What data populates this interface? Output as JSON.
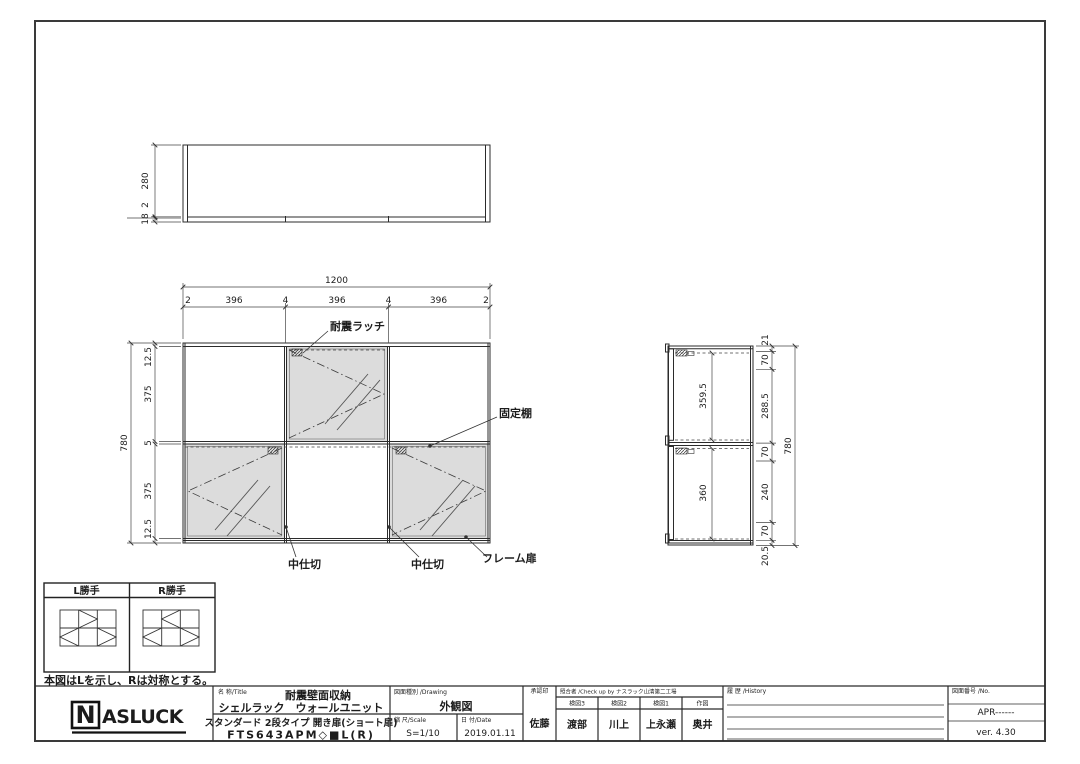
{
  "drawing": {
    "top_view": {
      "depth": "280",
      "gap": "2",
      "bottom": "18"
    },
    "front_view": {
      "width_total": "1200",
      "width_segments": [
        "2",
        "396",
        "4",
        "396",
        "4",
        "396",
        "2"
      ],
      "height_total": "780",
      "height_segments": [
        "12.5",
        "375",
        "5",
        "375",
        "12.5"
      ],
      "labels": {
        "latch": "耐震ラッチ",
        "fixed_shelf": "固定棚",
        "partition_left": "中仕切",
        "partition_right": "中仕切",
        "frame_door": "フレーム扉"
      }
    },
    "side_view": {
      "inner_top": "359.5",
      "inner_bottom": "360",
      "right_segments": [
        "21",
        "70",
        "288.5",
        "70",
        "240",
        "70",
        "20.5"
      ],
      "height_total": "780"
    },
    "handing": {
      "left": "L勝手",
      "right": "R勝手",
      "note": "本図はLを示し、Rは対称とする。"
    }
  },
  "title_block": {
    "logo": {
      "n": "N",
      "rest": "ASLUCK"
    },
    "name": {
      "header": "名 称/Title",
      "line1": "耐震壁面収納",
      "line2": "シェルラック　ウォールユニット",
      "line3": "スタンダード 2段タイプ 開き扉(ショート扉)",
      "line4": "FTS643APM◇■L(R)"
    },
    "drawing_type": {
      "header": "図面種別 /Drawing",
      "value": "外観図"
    },
    "scale": {
      "header": "縮 尺/Scale",
      "value": "S=1/10"
    },
    "date": {
      "header": "日 付/Date",
      "value": "2019.01.11"
    },
    "approval": {
      "header": "承認印",
      "value": "佐藤"
    },
    "check": {
      "header": "照合者 /Check up by ナスラック山清第二工場",
      "cols": [
        {
          "h": "検図3",
          "v": "渡部"
        },
        {
          "h": "検図2",
          "v": "川上"
        },
        {
          "h": "検図1",
          "v": "上永瀬"
        },
        {
          "h": "作図",
          "v": "奥井"
        }
      ]
    },
    "history": {
      "header": "履 歴 /History"
    },
    "number": {
      "header": "図面番号 /No.",
      "value": "APR------",
      "version": "ver. 4.30"
    }
  }
}
